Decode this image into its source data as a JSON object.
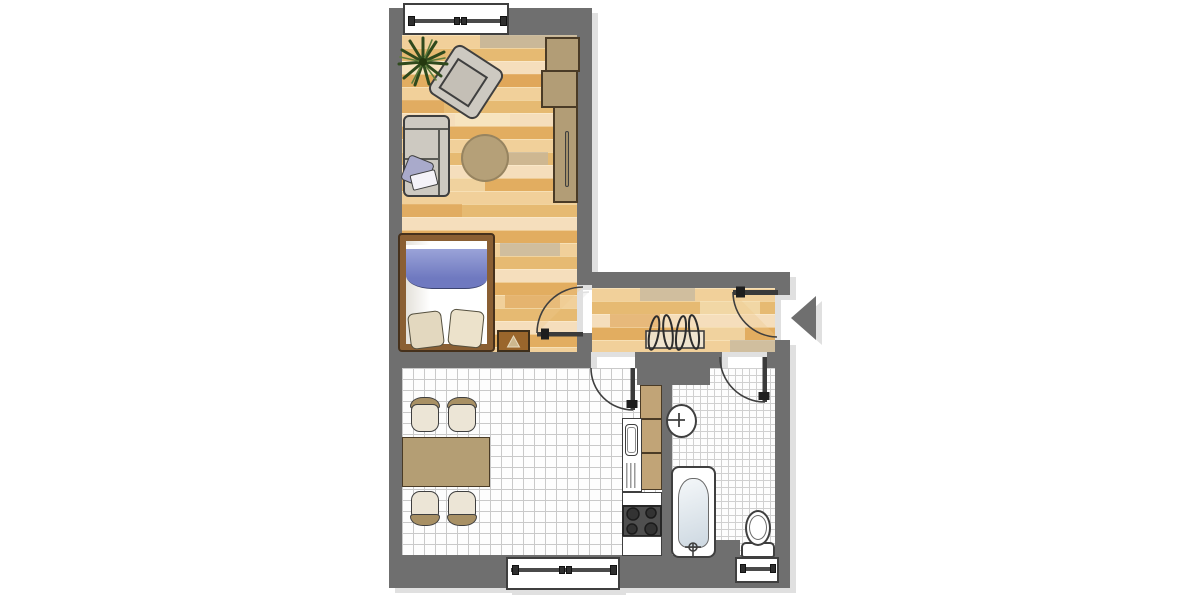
{
  "diagram": {
    "type": "apartment-floor-plan",
    "orientation": "entrance-on-right",
    "rooms": [
      {
        "name": "living-sleeping-room",
        "floor": "wood-parquet",
        "furniture": [
          "potted-plant",
          "armchair",
          "two-seat-sofa",
          "sofa-pillow",
          "round-rug",
          "wardrobe-two-part",
          "double-bed",
          "blue-blanket",
          "two-pillows",
          "nightstand-with-lamp-symbol"
        ]
      },
      {
        "name": "hallway",
        "floor": "wood-parquet",
        "furniture": [
          "coat-rack-with-hangers"
        ],
        "features": [
          "entrance-door",
          "entrance-direction-arrow"
        ]
      },
      {
        "name": "kitchen-dining-room",
        "floor": "large-white-tile",
        "furniture": [
          "dining-table",
          "dining-chairs x4",
          "kitchen-sink-with-drainer",
          "tan-countertop",
          "stove-four-burners",
          "white-counter-segments"
        ]
      },
      {
        "name": "bathroom",
        "floor": "small-white-tile",
        "furniture": [
          "wash-basin-with-tap",
          "bathtub-with-tap",
          "toilet-with-cistern"
        ]
      }
    ],
    "doors": [
      {
        "name": "entrance-door",
        "wall": "right-outer-wall",
        "swing": "into-hallway"
      },
      {
        "name": "bedroom-door",
        "wall": "between-hallway-and-living-room",
        "swing": "into-living-room"
      },
      {
        "name": "kitchen-door",
        "wall": "between-hallway-and-kitchen",
        "swing": "into-kitchen"
      },
      {
        "name": "bathroom-door",
        "wall": "between-hallway-and-bathroom",
        "swing": "into-bathroom"
      }
    ],
    "windows": [
      {
        "name": "living-room-window",
        "wall": "top-outer-wall",
        "handles": 4
      },
      {
        "name": "kitchen-window",
        "wall": "bottom-outer-wall",
        "handles": 4
      },
      {
        "name": "bathroom-window",
        "wall": "bottom-outer-wall",
        "handles": 2
      }
    ],
    "counts": {
      "dining_chairs": 4,
      "stove_burners": 4,
      "bed_pillows": 2,
      "coat_hangers": 4,
      "wardrobe_sections": 3
    },
    "colors": {
      "wall": "#6f6f6f",
      "wood_floor": "#eec98b",
      "tile_floor": "#fdfdfd",
      "tan_furniture": "#b29d76",
      "bed_frame": "#8a5f33",
      "blanket_blue": "#7680c4",
      "pillow_beige": "#e3d8bf",
      "sofa_gray": "#cdc9c1",
      "plant_green": "#2f4a1d",
      "outline": "#3f3f3f",
      "shadow": "#e0e0e0"
    }
  }
}
